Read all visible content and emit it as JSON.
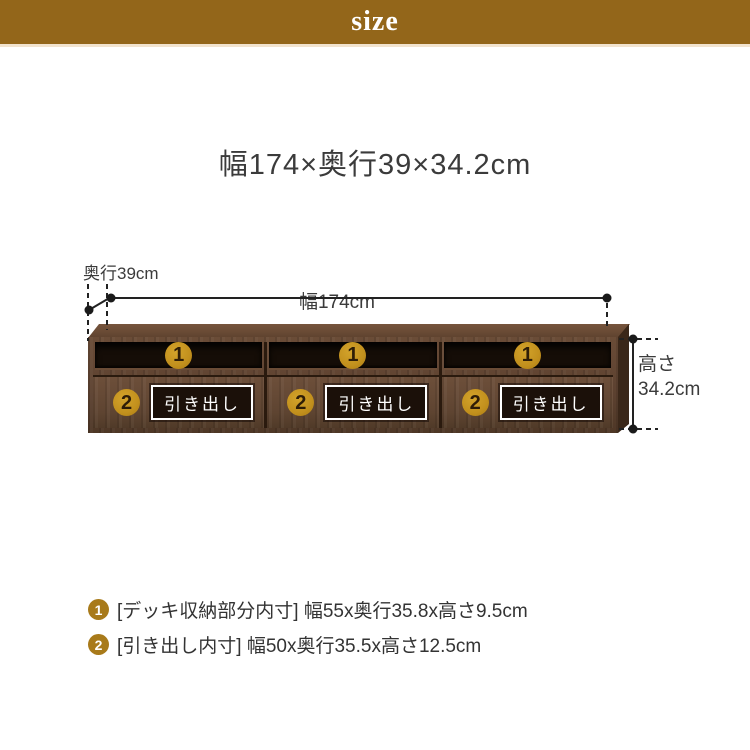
{
  "header": {
    "label": "size"
  },
  "title": "幅174×奥行39×34.2cm",
  "measurements": {
    "depth": "奥行39cm",
    "width": "幅174cm",
    "height_line1": "高さ",
    "height_line2": "34.2cm"
  },
  "cabinet": {
    "compartment_badge": "1",
    "drawer_badge": "2",
    "drawer_label": "引き出し",
    "compartment_count": 3,
    "drawer_count": 3
  },
  "legend": {
    "items": [
      {
        "badge": "1",
        "text": "[デッキ収納部分内寸] 幅55x奥行35.8x高さ9.5cm"
      },
      {
        "badge": "2",
        "text": "[引き出し内寸] 幅50x奥行35.5x高さ12.5cm"
      }
    ]
  },
  "colors": {
    "header_bg": "#93661A",
    "header_border": "#F2E3CE",
    "badge_gold": "#C2901D",
    "legend_badge_gold": "#A87A1A",
    "wood_front": "#5E4431",
    "wood_top": "#6B4C36",
    "compartment_dark": "#150D07",
    "text_dark": "#3B3B3B",
    "line_color": "#222222"
  }
}
